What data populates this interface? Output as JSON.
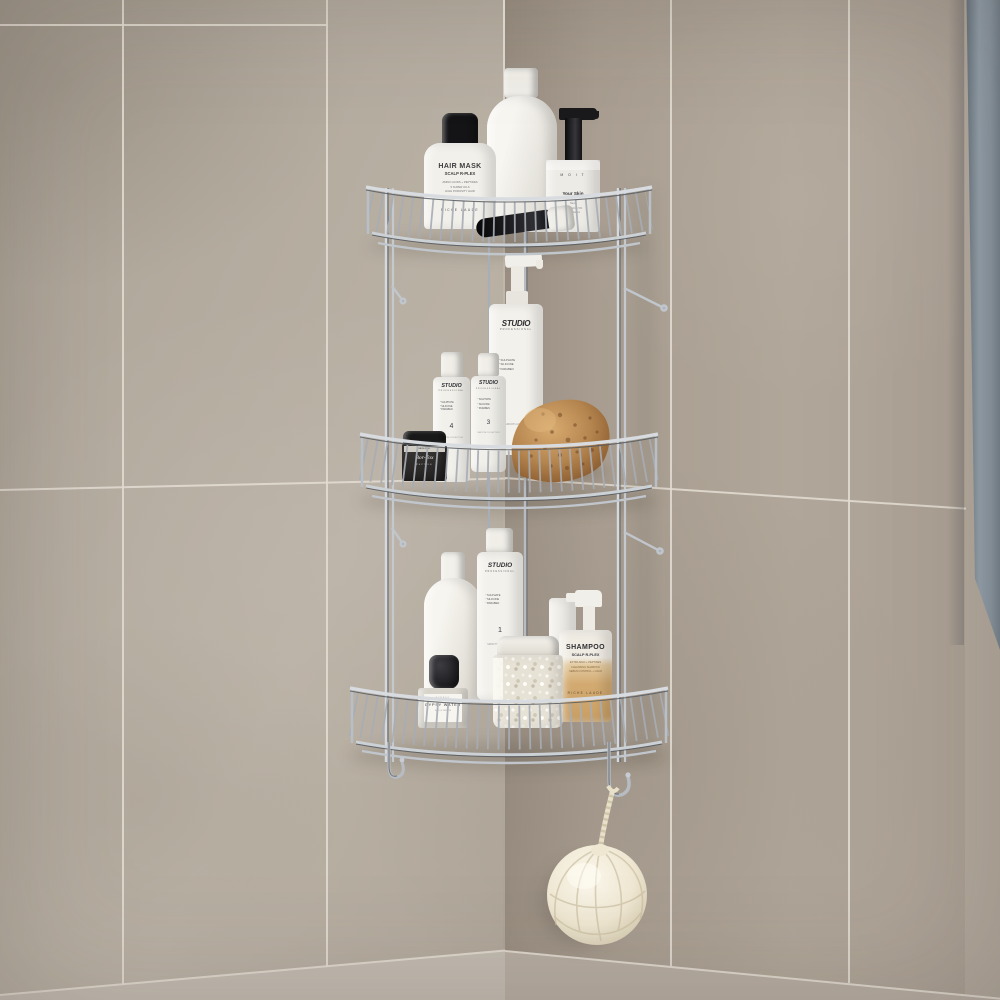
{
  "scene": {
    "description": "Photograph: three-tier chrome corner shower caddy in a beige stone-tiled bathroom corner, stocked with white hair/skin products, a natural sea sponge, a jar of bath salts, and a cream mesh loofah hanging from a hook",
    "tiers": "3",
    "hooks": "2",
    "colors": {
      "wall_left": "#b4aba0",
      "wall_right": "#a79c8f",
      "grout": "#e2dcd2",
      "glass_panel": "#8b97a1",
      "chrome": "#c3c9cf",
      "sponge": "#b5854f",
      "loofah": "#f2ead8",
      "shampoo_liquid": "#cfa467",
      "bottle_white": "#f3f1eb",
      "cap_black": "#151517"
    }
  },
  "products": {
    "hair_mask": {
      "title": "HAIR MASK",
      "subtitle": "SCALP R-PLEX",
      "line1": "AMINO ACIDS + PEPTIDES",
      "line2": "5 SUPER OILS",
      "line3": "HIGH POROSITY HAIR",
      "brand": "RICHE LAUDE"
    },
    "moit": {
      "brand": "M O I T",
      "title": "Your Skin",
      "line1": "Nano",
      "line2": "Moisturizing 5%",
      "line3": "Body Serum"
    },
    "studio_pump": {
      "logo": "STUDIO",
      "sub": "PROFESSIONAL",
      "line1": "SULPHATE",
      "line2": "SILICONE",
      "line3": "PARABEN",
      "foot": "SMOOTH ACTION"
    },
    "studio_4": {
      "logo": "STUDIO",
      "sub": "PROFESSIONAL",
      "line1": "SULPHATE",
      "line2": "SILICONE",
      "line3": "PARABEN",
      "number": "4",
      "foot": "SMOOTH COLLECTION"
    },
    "studio_3": {
      "logo": "STUDIO",
      "sub": "PROFESSIONAL",
      "line1": "SULPHATE",
      "line2": "SILICONE",
      "line3": "PARABEN",
      "number": "3",
      "foot": "SMOOTH COLLECTION"
    },
    "studio_1": {
      "logo": "STUDIO",
      "sub": "PROFESSIONAL",
      "line1": "SULPHATE",
      "line2": "SILICONE",
      "line3": "PARABEN",
      "number": "1",
      "foot": "SMOOTH COLLECTION"
    },
    "bortox": {
      "band": "MEDI-PEEL",
      "title": "Bor-Tox",
      "sub": "PEPTIDE"
    },
    "shampoo_spray": {
      "title": "SHAMPOO",
      "subtitle": "SCALP R-PLEX",
      "line1": "EXTRA MILD + PEPTIDES",
      "line2": "CLEANSING SHAMPOO",
      "line3": "SEBUM CONTROL + CALM",
      "brand": "RICHE LAUDE"
    },
    "gypsy_water": {
      "brand": "BYREDO",
      "title": "GYPSY WATER",
      "sub": "EAU DE PARFUM"
    }
  },
  "accessories": {
    "sponge": "natural-sea-sponge",
    "loofah": "cream-mesh-loofah-on-rope",
    "salt_jar": "jar-of-white-bath-salts"
  }
}
